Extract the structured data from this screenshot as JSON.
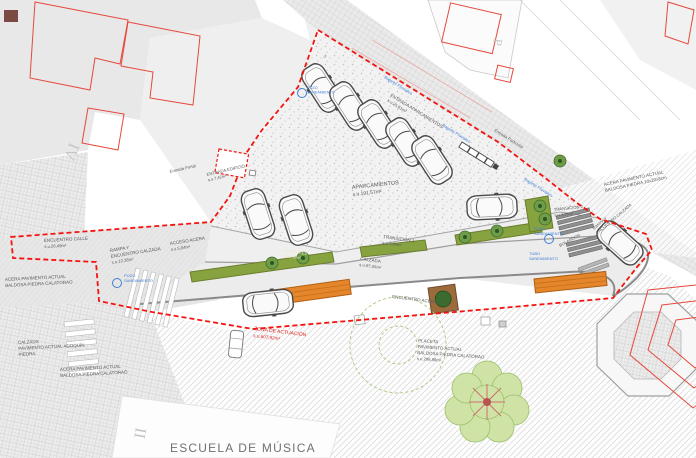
{
  "title": "ESCUELA DE MÚSICA",
  "colors": {
    "boundary_red": "#f3140f",
    "building_red": "#e6483c",
    "annotation_blue": "#3f7fd6",
    "parterre_green": "#87a33f",
    "bench_orange": "#e5862b",
    "muted_text": "#5a5a5a"
  },
  "labels": {
    "entrada_portal": "Entrada Portal",
    "entrada_edificio_1": "ENTRADA EDIFICIO",
    "entrada_edificio_2": "s.u.7,42m²",
    "entrada_aparcamientos_1": "ENTRADA APARCAMIENTOS",
    "entrada_aparcamientos_2": "s.u.25,61m²",
    "bajante_pluviales": "Bajante Pluviales",
    "entrada_particular": "Entrada Particular",
    "aparcamientos_1": "APARCAMIENTOS",
    "aparcamientos_2": "s.u.191,57m²",
    "transicion1_1": "TRANSICIÓN 1",
    "transicion1_2": "s.u.7,55m²",
    "calzada_1": "CALZADA",
    "calzada_2": "s.u.97,55m²",
    "parterres_1": "PARTERRES",
    "parterres_2": "s.u.9,66m²",
    "encuentro_calle_1": "ENCUENTRO CALLE",
    "encuentro_calle_2": "s.u.26,49m²",
    "rampa_1": "RAMPA Y",
    "rampa_2": "ENCUENTRO CALZADA",
    "rampa_3": "s.u.12,36m²",
    "acceso_acera_1": "ACCESO ACERA",
    "acceso_acera_2": "s.u.5,94m²",
    "acera_left_1": "ACERA PAVIMENTO ACTUAL",
    "acera_left_2": "BALDOSA PIEDRA CALATORAO",
    "pozo_1": "POZO",
    "pozo_2": "SANEAMIENTO",
    "tubo_1": "TUBO",
    "tubo_2": "SANEAMIENTO",
    "calzada_pav_1": "CALZADA",
    "calzada_pav_2": "PAVIMENTO ACTUAL ADOQUÍN",
    "calzada_pav_3": "PIEDRA",
    "acera_bottom_1": "ACERA PAVIMENTO ACTUAL",
    "acera_bottom_2": "BALDOSA PIEDRA CALATORAO",
    "zona_1": "ZONA DE ACTUACIÓN",
    "zona_2": "s.u.607,92m²",
    "encuentro_acera": "ENCUENTRO ACERA",
    "placeta_1": "PLACETA",
    "placeta_2": "PAVIMENTO ACTUAL",
    "placeta_3": "BALDOSA PIEDRA CALATORAO",
    "placeta_4": "s.u.296,88m²",
    "acera_right_1": "ACERA PAVIMENTO ACTUAL",
    "acera_right_2": "BALDOSA PIEDRA 10x20x8cm",
    "transicion2_1": "TRANSICIÓN 2",
    "transicion2_2": "s.u.3,15m²",
    "bolardos": "BOLARDOS",
    "rampa_right_1": "RAMPA Y",
    "rampa_right_2": "ENCUENTRO CALZADA",
    "roman_iv": "IV",
    "roman_ii": "II",
    "letter_p": "P",
    "num_3": "3"
  }
}
